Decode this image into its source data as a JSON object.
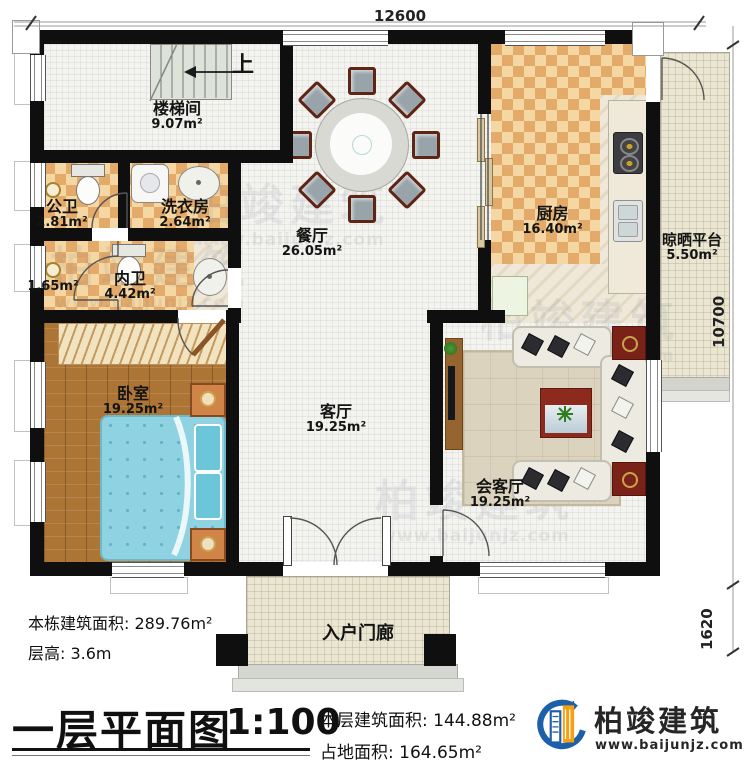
{
  "rooms": {
    "stairwell": {
      "name": "楼梯间",
      "area": "9.07m²"
    },
    "public_bath": {
      "name": "公卫",
      "area": "2.81m²"
    },
    "laundry": {
      "name": "洗衣房",
      "area": "2.64m²"
    },
    "closet": {
      "area": "1.65m²"
    },
    "ensuite": {
      "name": "内卫",
      "area": "4.42m²"
    },
    "dining": {
      "name": "餐厅",
      "area": "26.05m²"
    },
    "kitchen": {
      "name": "厨房",
      "area": "16.40m²"
    },
    "platform": {
      "name": "晾晒平台",
      "area": "5.50m²"
    },
    "bedroom": {
      "name": "卧室",
      "area": "19.25m²"
    },
    "living": {
      "name": "客厅",
      "area": "19.25m²"
    },
    "reception": {
      "name": "会客厅",
      "area": "19.25m²"
    },
    "porch": {
      "name": "入户门廊"
    }
  },
  "stair_up": "上",
  "dims": {
    "top": "12600",
    "right_upper": "10700",
    "right_lower": "1620"
  },
  "info_left": {
    "line1": "本栋建筑面积: 289.76m²",
    "line2": "层高: 3.6m"
  },
  "titleblock": {
    "title": "一层平面图",
    "scale": "1:100",
    "line1": "本层建筑面积: 144.88m²",
    "line2": "占地面积: 164.65m²"
  },
  "brand": {
    "name": "柏竣建筑",
    "url": "www.baijunjz.com"
  },
  "watermark": {
    "name": "柏竣建筑",
    "url": "www.baijunjz.com"
  },
  "colors": {
    "wall": "#0f0f0f",
    "logo_blue": "#1d5fa8",
    "logo_orange": "#f5a013",
    "bed": "#8fd3e2",
    "checker_light": "#f4d7a2",
    "checker_dark": "#e4aa6a"
  }
}
